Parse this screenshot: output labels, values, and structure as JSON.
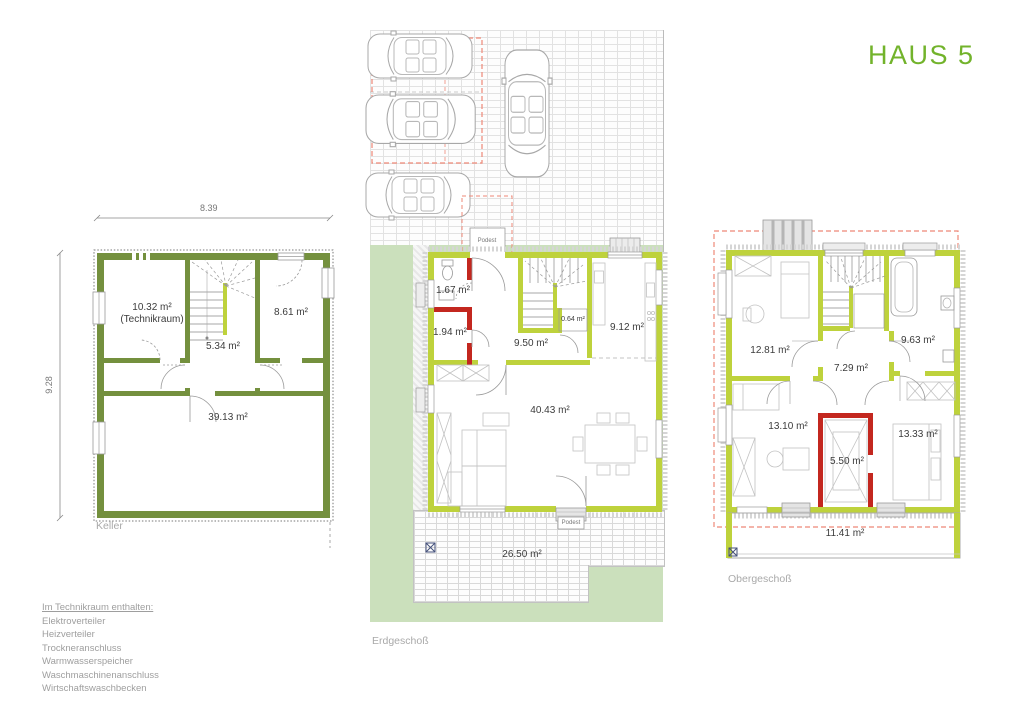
{
  "title": "HAUS 5",
  "colors": {
    "accent_green": "#72b32b",
    "wall_olive": "#74903e",
    "wall_lime": "#bed23c",
    "wall_red": "#c3271f",
    "lawn_green": "#cbe0bc",
    "roof_dash_red": "#ee8877"
  },
  "plans": {
    "keller": {
      "name": "Keller",
      "dims": {
        "width": "8.39",
        "height": "9.28"
      },
      "rooms": {
        "technikraum": {
          "area": "10.32 m²",
          "note": "(Technikraum)"
        },
        "room_861": {
          "area": "8.61 m²"
        },
        "room_534": {
          "area": "5.34 m²"
        },
        "room_3913": {
          "area": "39.13 m²"
        }
      }
    },
    "erdgeschoss": {
      "name": "Erdgeschoß",
      "rooms": {
        "wc": {
          "area": "1.67 m²"
        },
        "storage": {
          "area": "1.94 m²"
        },
        "hall": {
          "area": "9.50 m²"
        },
        "under_stairs": {
          "area": "0.64 m²"
        },
        "kitchen": {
          "area": "9.12 m²"
        },
        "living": {
          "area": "40.43 m²"
        },
        "terrace": {
          "area": "26.50 m²"
        }
      },
      "podest_top": "Podest",
      "podest_bottom": "Podest"
    },
    "obergeschoss": {
      "name": "Obergeschoß",
      "rooms": {
        "bedroom1": {
          "area": "12.81 m²"
        },
        "bath": {
          "area": "9.63 m²"
        },
        "hall": {
          "area": "7.29 m²"
        },
        "bedroom2": {
          "area": "13.10 m²"
        },
        "closet": {
          "area": "5.50 m²"
        },
        "bedroom3": {
          "area": "13.33 m²"
        },
        "balcony": {
          "area": "11.41 m²"
        }
      }
    }
  },
  "note": {
    "heading": "Im Technikraum enthalten:",
    "items": [
      "Elektroverteiler",
      "Heizverteiler",
      "Trockneranschluss",
      "Warmwasserspeicher",
      "Waschmaschinenanschluss",
      "Wirtschaftswaschbecken"
    ]
  }
}
